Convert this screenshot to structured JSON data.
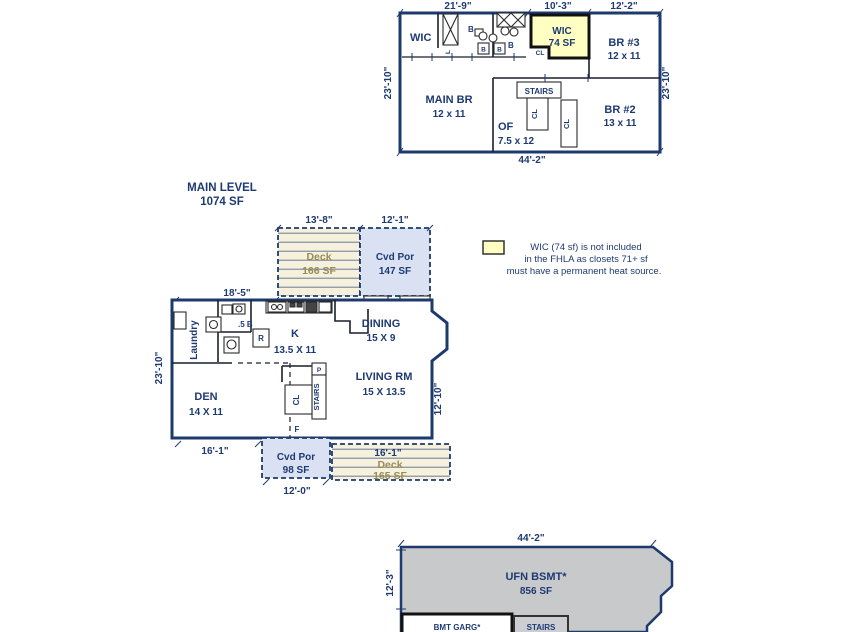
{
  "colors": {
    "navy_text": "#1e3a73",
    "wall_navy": "#1c3a6b",
    "wic_yellow": "#ffffc2",
    "porch_blue": "#d9e1f2",
    "deck_cream": "#f6f1dd",
    "deck_text": "#9a8c55",
    "bsmt_gray": "#c8c9cb"
  },
  "upper_level": {
    "dims": {
      "top_left": "21'-9\"",
      "top_mid": "10'-3\"",
      "top_right": "12'-2\"",
      "left": "23'-10\"",
      "right": "23'-10\"",
      "bottom": "44'-2\""
    },
    "labels": {
      "wic_hall": "WIC",
      "linen": "L",
      "b_main": "B",
      "b_sq1": "B",
      "b_sq2": "B",
      "b_small": "B",
      "wic_name": "WIC",
      "wic_sf": "74 SF",
      "wic_cl": "CL",
      "br3_name": "BR #3",
      "br3_dim": "12 x 11",
      "main_br_name": "MAIN BR",
      "main_br_dim": "12 x 11",
      "stairs": "STAIRS",
      "stairs_cl": "CL",
      "hall_cl": "CL",
      "of_name": "OF",
      "of_dim": "7.5 x 12",
      "br2_name": "BR #2",
      "br2_dim": "13 x 11"
    }
  },
  "main_level": {
    "title": "MAIN LEVEL",
    "title_sf": "1074 SF",
    "dims": {
      "deck_top": "13'-8\"",
      "cvd_top": "12'-1\"",
      "top_left": "18'-5\"",
      "left": "23'-10\"",
      "right": "12'-10\"",
      "bottom_left": "16'-1\"",
      "deck_bottom": "16'-1\"",
      "cvd_bottom": "12'-0\""
    },
    "deck_top": {
      "name": "Deck",
      "sf": "166 SF"
    },
    "cvd_top": {
      "name": "Cvd Por",
      "sf": "147 SF"
    },
    "labels": {
      "laundry": "Laundry",
      "half_bath": ".5 B",
      "fridge": "R",
      "k_name": "K",
      "k_dim": "13.5 X 11",
      "dining_name": "DINING",
      "dining_dim": "15 X 9",
      "den_name": "DEN",
      "den_dim": "14 X 11",
      "living_name": "LIVING RM",
      "living_dim": "15 X 13.5",
      "stairs": "STAIRS",
      "cl": "CL",
      "pantry": "P",
      "furnace": "F"
    },
    "cvd_bottom": {
      "name": "Cvd Por",
      "sf": "98 SF"
    },
    "deck_bottom": {
      "name": "Deck",
      "sf": "165 SF"
    }
  },
  "legend": {
    "line1": "WIC (74 sf) is not included",
    "line2": "in the FHLA as closets 71+ sf",
    "line3": "must have a permanent heat source."
  },
  "basement": {
    "dim_top": "44'-2\"",
    "dim_left": "12'-3\"",
    "name": "UFN BSMT*",
    "sf": "856 SF",
    "garage": "BMT GARG*",
    "stairs": "STAIRS"
  }
}
